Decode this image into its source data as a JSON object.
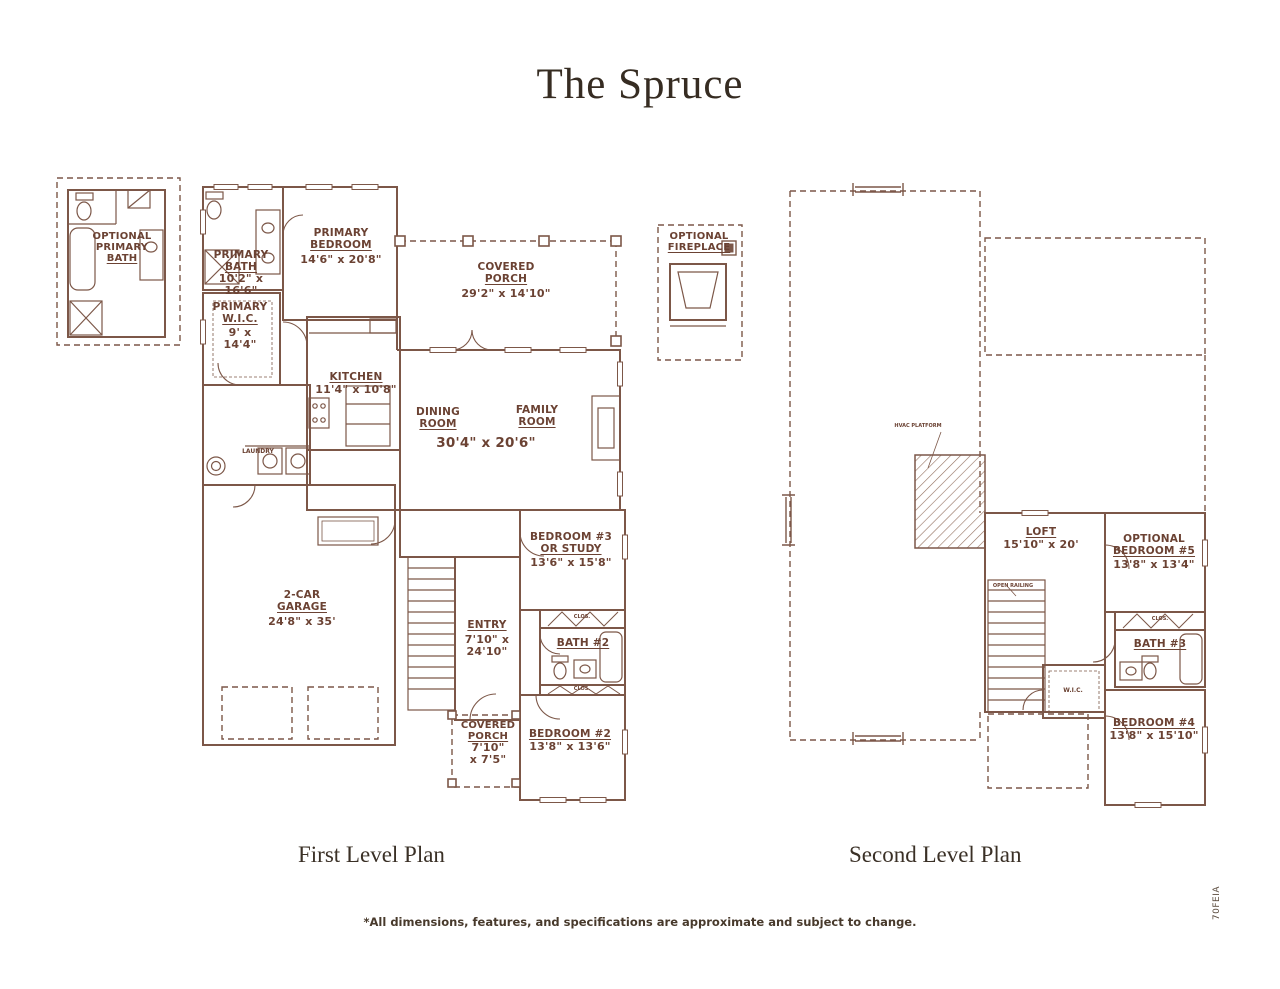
{
  "page": {
    "title": "The Spruce",
    "footnote": "*All dimensions, features, and specifications are approximate and subject to change.",
    "plan_code": "70FEIA",
    "colors": {
      "wall_line": "#7c5748",
      "label_text": "#6b4233",
      "heading_text": "#3a3026"
    }
  },
  "first_floor": {
    "caption": "First Level Plan",
    "optional_primary_bath": {
      "name1": "OPTIONAL",
      "name2": "PRIMARY",
      "name3": "BATH"
    },
    "primary_bath": {
      "name1": "PRIMARY",
      "name2": "BATH",
      "dims1": "10'2\" x",
      "dims2": "16'6\""
    },
    "primary_bedroom": {
      "name1": "PRIMARY",
      "name2": "BEDROOM",
      "dims1": "14'6\" x 20'8\""
    },
    "covered_porch": {
      "name1": "COVERED",
      "name2": "PORCH",
      "dims1": "29'2\" x 14'10\""
    },
    "primary_wic": {
      "name1": "PRIMARY",
      "name2": "W.I.C.",
      "dims1": "9' x",
      "dims2": "14'4\""
    },
    "kitchen": {
      "name1": "KITCHEN",
      "dims1": "11'4\" x 10'8\""
    },
    "dining_room": {
      "name1": "DINING",
      "name2": "ROOM"
    },
    "family_room": {
      "name1": "FAMILY",
      "name2": "ROOM"
    },
    "dining_family_dims": "30'4\" x 20'6\"",
    "laundry": {
      "name1": "LAUNDRY"
    },
    "garage": {
      "name1": "2-CAR",
      "name2": "GARAGE",
      "dims1": "24'8\" x 35'"
    },
    "entry": {
      "name1": "ENTRY",
      "dims1": "7'10\" x",
      "dims2": "24'10\""
    },
    "bedroom3": {
      "name1": "BEDROOM #3",
      "name2": "OR STUDY",
      "dims1": "13'6\" x 15'8\""
    },
    "bath2": {
      "name1": "BATH #2"
    },
    "bedroom2": {
      "name1": "BEDROOM #2",
      "dims1": "13'8\" x 13'6\""
    },
    "rear_covered_porch": {
      "name1": "COVERED",
      "name2": "PORCH",
      "dims1": "7'10\"",
      "dims2": "x 7'5\""
    },
    "optional_fireplace": {
      "name1": "OPTIONAL",
      "name2": "FIREPLACE"
    },
    "closet": "CLOS."
  },
  "second_floor": {
    "caption": "Second Level Plan",
    "loft": {
      "name1": "LOFT",
      "dims1": "15'10\" x 20'"
    },
    "optional_bedroom5": {
      "name1": "OPTIONAL",
      "name2": "BEDROOM #5",
      "dims1": "13'8\" x 13'4\""
    },
    "bath3": {
      "name1": "BATH #3"
    },
    "bedroom4": {
      "name1": "BEDROOM #4",
      "dims1": "13'8\" x 15'10\""
    },
    "wic": "W.I.C.",
    "closet": "CLOS.",
    "hvac_platform": "HVAC PLATFORM",
    "open_railing": "OPEN RAILING"
  }
}
